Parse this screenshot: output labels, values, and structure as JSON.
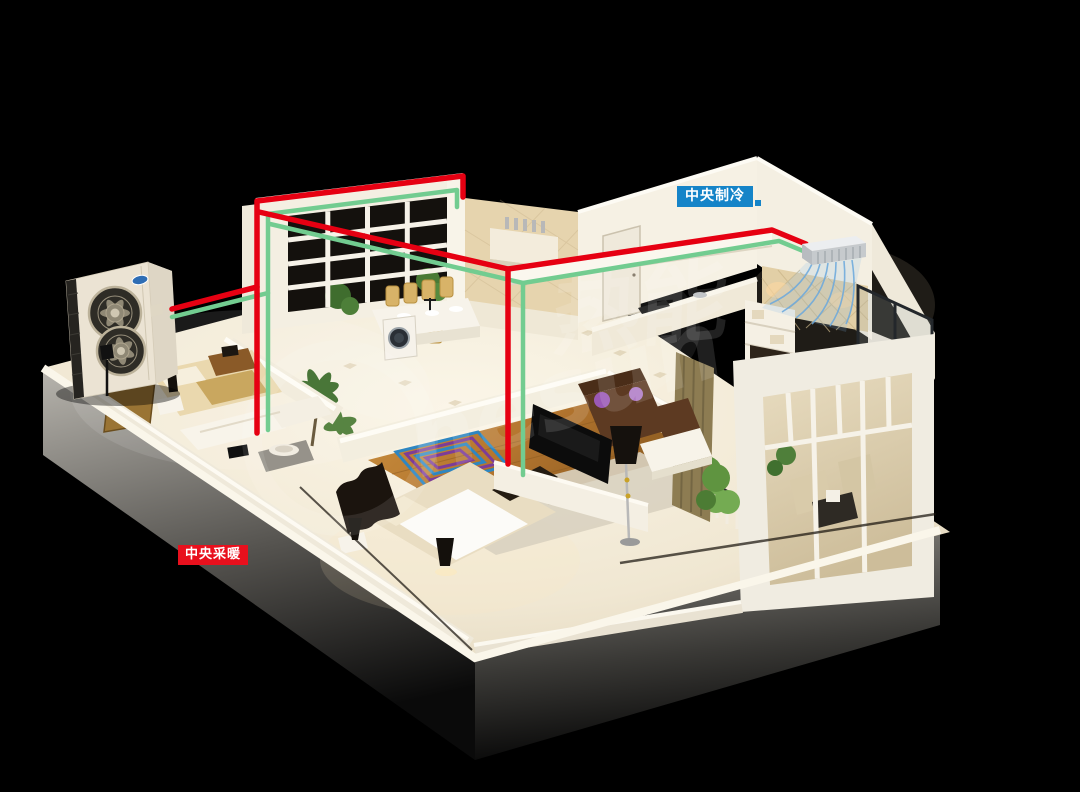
{
  "scene": {
    "bg_color": "#000000"
  },
  "callouts": {
    "cooling": {
      "text": "中央制冷",
      "bg_color": "#1584c8",
      "text_color": "#ffffff"
    },
    "heating": {
      "text": "中央采暖",
      "bg_color": "#e8101d",
      "text_color": "#ffffff"
    }
  },
  "pipes": {
    "supply_color": "#e60012",
    "return_color": "#72cc90"
  },
  "indoor_unit": {
    "airflow_color": "#6aa8dd"
  },
  "outdoor_unit": {
    "logo_color": "#2e6db4"
  },
  "watermark": {
    "text_cn": "热能",
    "text_en": "nesun",
    "color": "#ffffff"
  }
}
